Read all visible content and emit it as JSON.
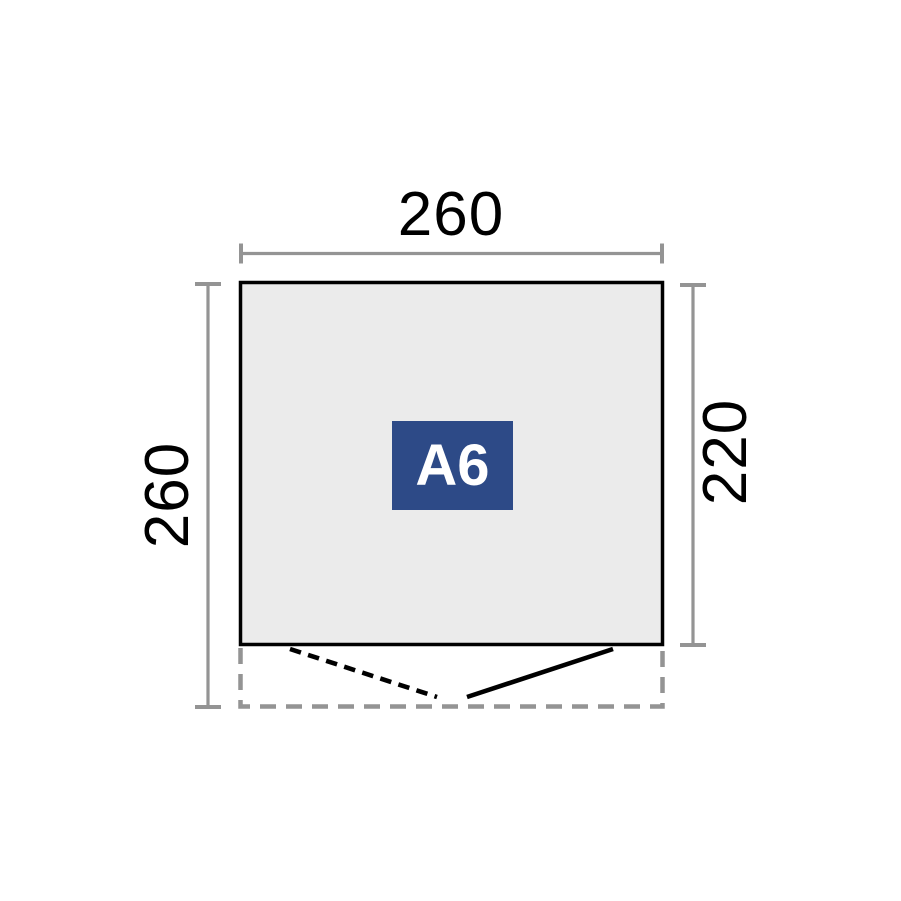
{
  "figure": {
    "type": "shed-floor-plan",
    "product_label": "A6",
    "dimensions": {
      "overall_width": "260",
      "overall_depth": "260",
      "building_depth": "220"
    },
    "colors": {
      "badge_bg": "#2d4a87",
      "badge_text": "#ffffff",
      "plan_fill": "#ebebeb",
      "outline": "#000000",
      "dimension_gray": "#949494"
    }
  }
}
